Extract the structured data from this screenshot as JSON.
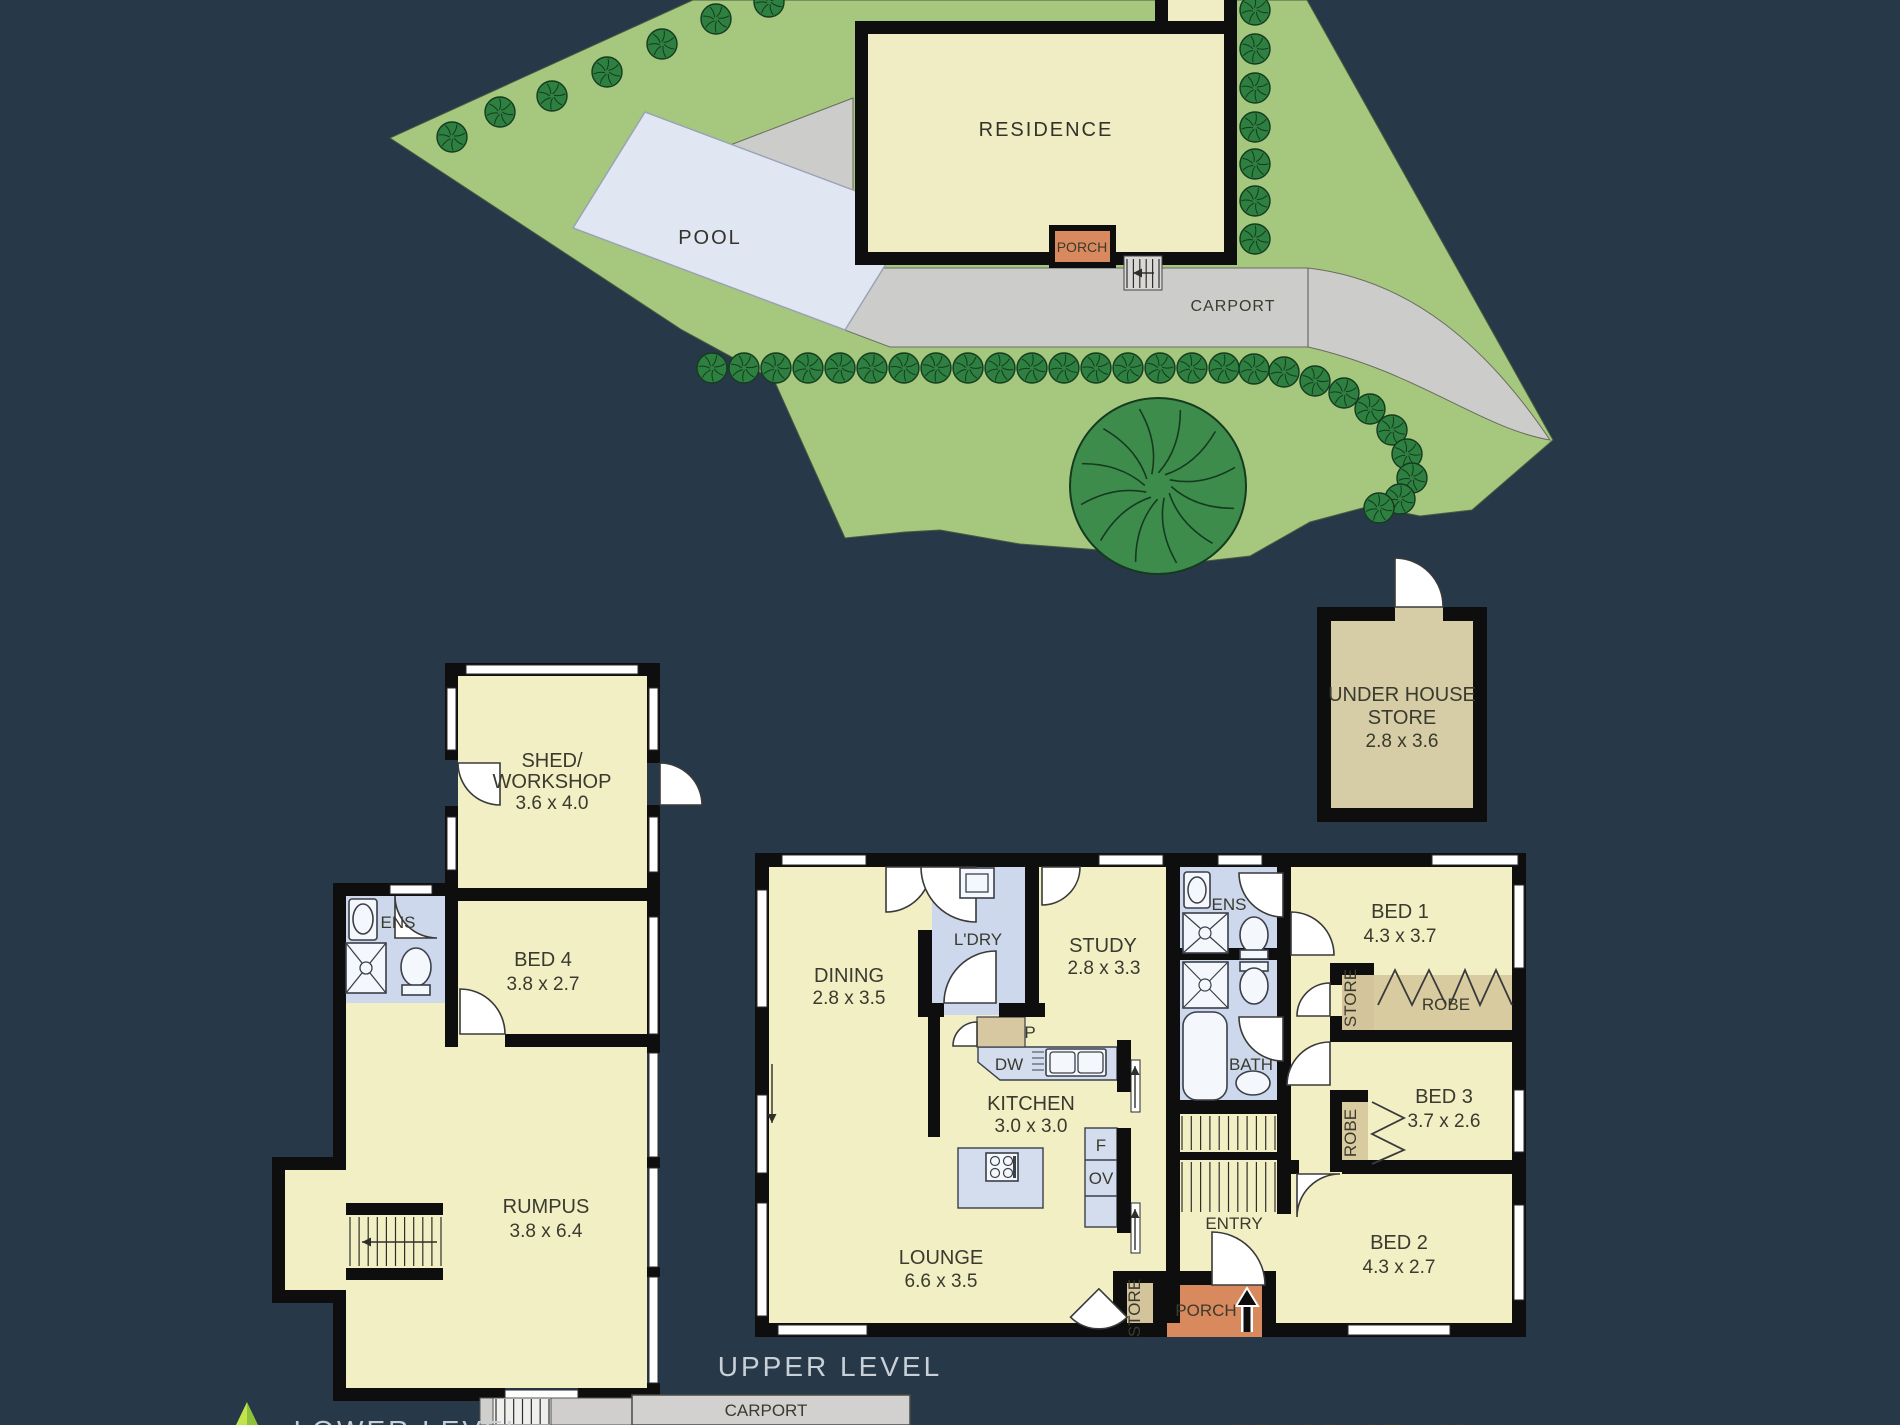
{
  "colors": {
    "background": "#273949",
    "lawn": "#a5c87e",
    "driveway": "#ccccca",
    "pool": "#e0e7f3",
    "room_yellow": "#f2efc5",
    "wet_blue": "#cdd8ec",
    "bench_blue": "#d4ddee",
    "robe_tan": "#d8cba0",
    "porch_orange": "#d8895e",
    "wall_black": "#0e0e0e",
    "tree_green": "#2e8040",
    "big_tree_green": "#3d8c4c",
    "title_grey": "#c8cfd6",
    "logo_lime": "#a6cf38"
  },
  "site": {
    "residence_label": "RESIDENCE",
    "pool_label": "POOL",
    "porch_label": "PORCH",
    "carport_label": "CARPORT",
    "trees": {
      "small_radius": 15,
      "top_row": [
        [
          452,
          137
        ],
        [
          500,
          112
        ],
        [
          552,
          96
        ],
        [
          607,
          72
        ],
        [
          662,
          44
        ],
        [
          716,
          19
        ],
        [
          769,
          2
        ]
      ],
      "right_column": [
        [
          1255,
          10
        ],
        [
          1255,
          49
        ],
        [
          1255,
          88
        ],
        [
          1255,
          127
        ],
        [
          1255,
          164
        ],
        [
          1255,
          201
        ],
        [
          1255,
          239
        ]
      ],
      "bottom_row": [
        [
          712,
          368
        ],
        [
          744,
          368
        ],
        [
          776,
          368
        ],
        [
          808,
          368
        ],
        [
          840,
          368
        ],
        [
          872,
          368
        ],
        [
          904,
          368
        ],
        [
          936,
          368
        ],
        [
          968,
          368
        ],
        [
          1000,
          368
        ],
        [
          1032,
          368
        ],
        [
          1064,
          368
        ],
        [
          1096,
          368
        ],
        [
          1128,
          368
        ],
        [
          1160,
          368
        ],
        [
          1192,
          368
        ],
        [
          1224,
          368
        ],
        [
          1254,
          369
        ]
      ],
      "arc": [
        [
          1284,
          372
        ],
        [
          1315,
          381
        ],
        [
          1344,
          393
        ],
        [
          1370,
          409
        ],
        [
          1392,
          430
        ],
        [
          1407,
          454
        ],
        [
          1412,
          478
        ],
        [
          1400,
          499
        ],
        [
          1379,
          508
        ]
      ],
      "big": [
        1158,
        486,
        88
      ]
    }
  },
  "under_house_store": {
    "line1": "UNDER HOUSE",
    "line2": "STORE",
    "dims": "2.8 x 3.6"
  },
  "lower_level": {
    "title": "LOWER LEVEL",
    "shed": {
      "line1": "SHED/",
      "line2": "WORKSHOP",
      "dims": "3.6 x 4.0"
    },
    "bed4": {
      "name": "BED 4",
      "dims": "3.8 x 2.7"
    },
    "ens_label": "ENS",
    "rumpus": {
      "name": "RUMPUS",
      "dims": "3.8 x 6.4"
    },
    "carport": {
      "name": "CARPORT",
      "dims": "5.5 x 3.2"
    }
  },
  "upper_level": {
    "title": "UPPER LEVEL",
    "dining": {
      "name": "DINING",
      "dims": "2.8 x 3.5"
    },
    "laundry_label": "L'DRY",
    "study": {
      "name": "STUDY",
      "dims": "2.8 x 3.3"
    },
    "pantry_label": "P",
    "dishwasher_label": "DW",
    "kitchen": {
      "name": "KITCHEN",
      "dims": "3.0 x 3.0"
    },
    "fridge_label": "F",
    "oven_label": "OV",
    "lounge": {
      "name": "LOUNGE",
      "dims": "6.6 x 3.5"
    },
    "store_lounge_label": "STORE",
    "entry_label": "ENTRY",
    "porch_label": "PORCH",
    "ens_label": "ENS",
    "bath_label": "BATH",
    "bed1": {
      "name": "BED 1",
      "dims": "4.3 x 3.7"
    },
    "robe1_label": "ROBE",
    "store_hall_label": "STORE",
    "bed3": {
      "name": "BED 3",
      "dims": "3.7 x 2.6"
    },
    "robe3_label": "ROBE",
    "bed2": {
      "name": "BED 2",
      "dims": "4.3 x 2.7"
    }
  },
  "footer": {
    "residence_label": "RESIDENCE",
    "area": "186 m²"
  }
}
